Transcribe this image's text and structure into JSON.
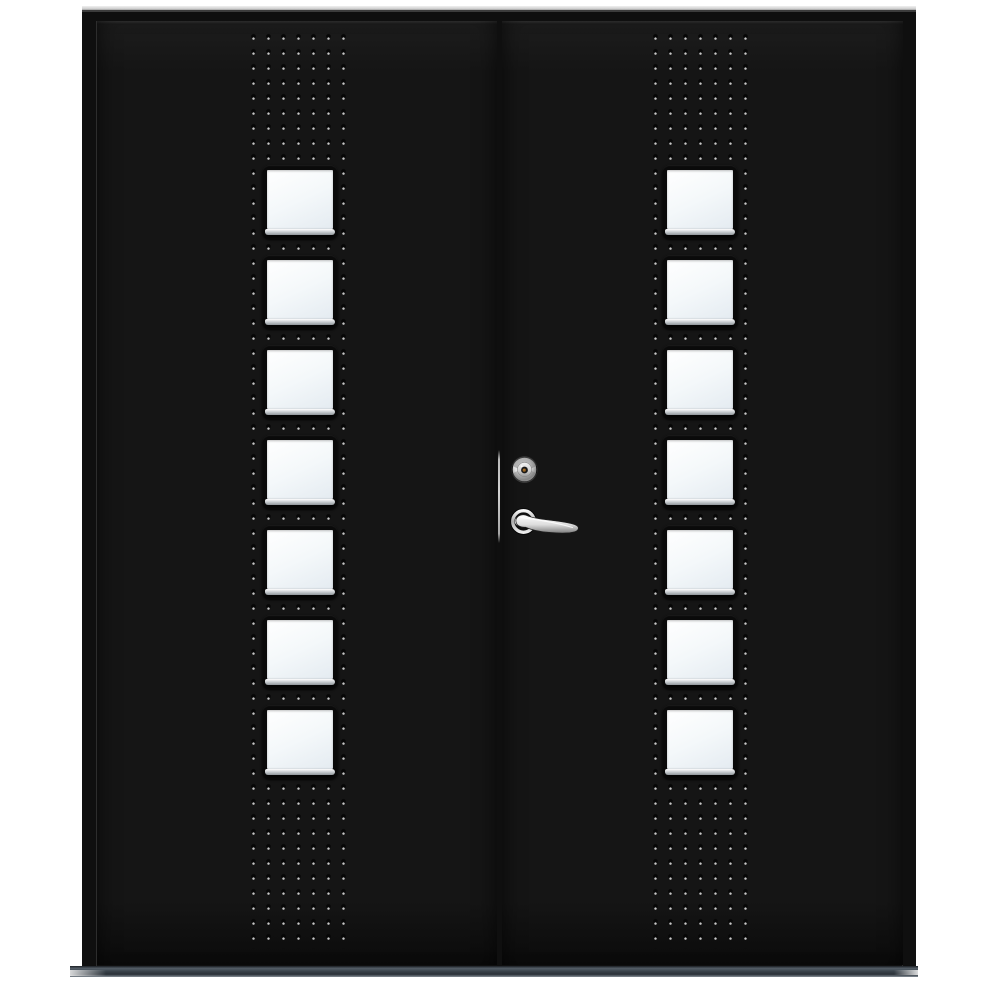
{
  "scene": {
    "subject": "Black double entry door with seven square glass panes per leaf, riveted stud pattern strips, chrome keyed cylinder and lever handle",
    "view": "front product photo on white background",
    "background_color": "#ffffff"
  },
  "colors": {
    "background": "#ffffff",
    "frame": "#0f0f0f",
    "leaf": "#151515",
    "top_trim": "#c9c9c9",
    "stud_dark": "#060606",
    "stud_light": "#c6c6c6",
    "window_frame": "#0a0a0a",
    "glass_light": "#ffffff",
    "glass_shade": "#e4ebf1",
    "window_sill": "#c2c7cb",
    "gap_highlight": "#d2d2d2",
    "sill_top": "#555f68",
    "sill_mid": "#39424a",
    "hardware_chrome": "#e8e8e8",
    "keyhole_brass": "#8a5a22"
  },
  "structure": {
    "leaves": 2,
    "windows_per_leaf": 7,
    "stud_columns_per_leaf": 7,
    "stud_rows_per_leaf": 61,
    "hardware": {
      "items": [
        "lock-cylinder",
        "lever-handle"
      ],
      "location": "right leaf, mid-height beside meeting stile"
    }
  }
}
